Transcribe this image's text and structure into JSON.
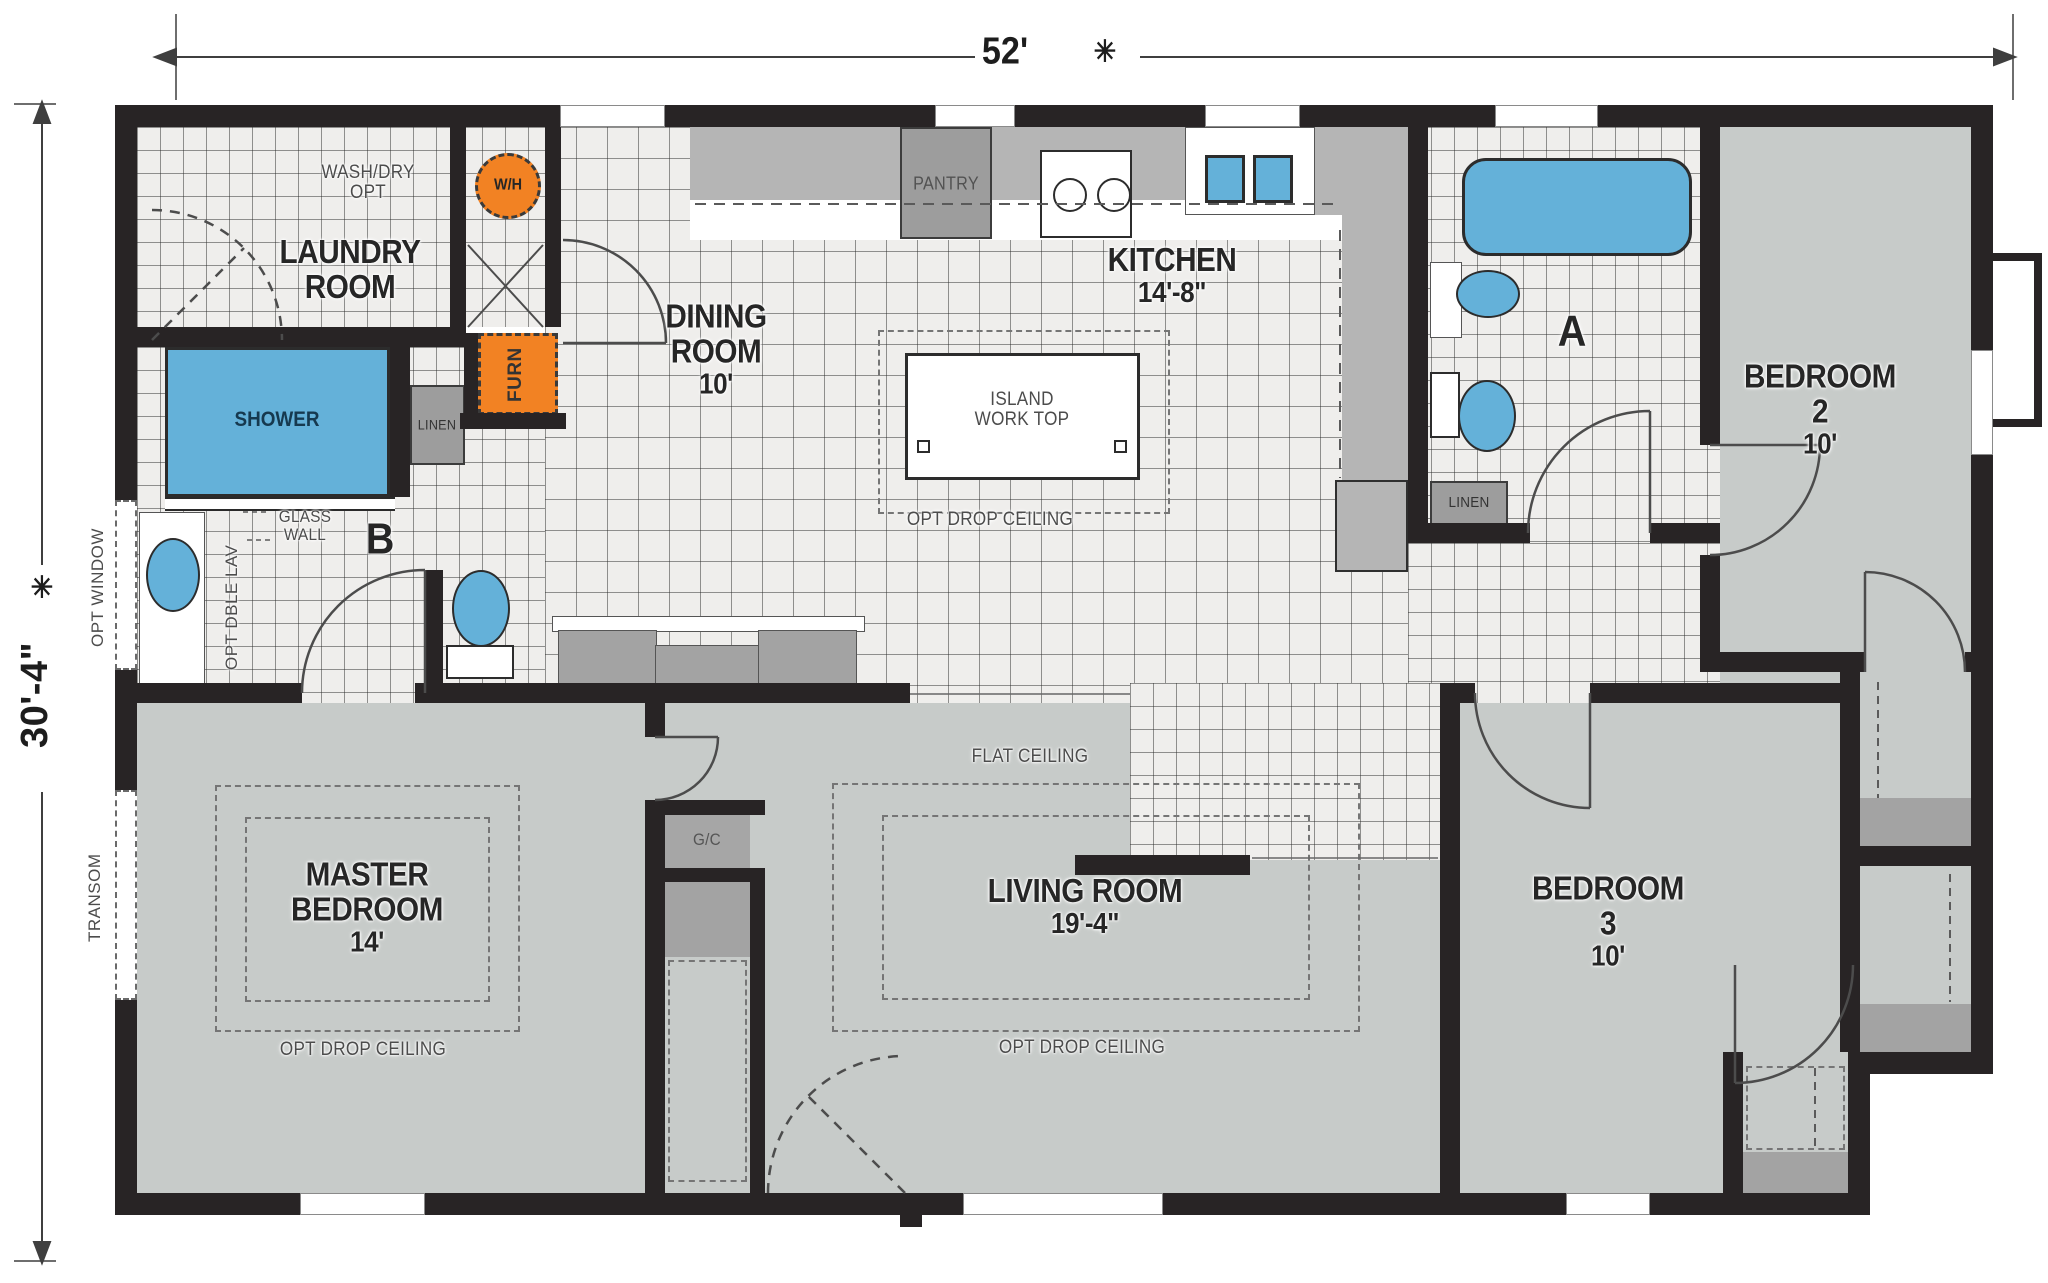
{
  "plan": {
    "dim_width": "52'",
    "dim_height": "30'-4\"",
    "star": "✳"
  },
  "rooms": {
    "laundry": {
      "lines": [
        "LAUNDRY",
        "ROOM"
      ]
    },
    "dining": {
      "lines": [
        "DINING",
        "ROOM",
        "10'"
      ]
    },
    "kitchen": {
      "lines": [
        "KITCHEN",
        "14'-8\""
      ]
    },
    "bedroom2": {
      "lines": [
        "BEDROOM",
        "2",
        "10'"
      ]
    },
    "bedroom3": {
      "lines": [
        "BEDROOM",
        "3",
        "10'"
      ]
    },
    "master": {
      "lines": [
        "MASTER",
        "BEDROOM",
        "14'"
      ]
    },
    "living": {
      "lines": [
        "LIVING ROOM",
        "19'-4\""
      ]
    }
  },
  "labels": {
    "wash_dry": {
      "lines": [
        "WASH/DRY",
        "OPT"
      ]
    },
    "wh": "W/H",
    "furn": "FURN",
    "pantry": "PANTRY",
    "linen_b": "LINEN",
    "linen_a": "LINEN",
    "island": {
      "lines": [
        "ISLAND",
        "WORK TOP"
      ]
    },
    "opt_drop_ceiling_kitchen": "OPT DROP CEILING",
    "opt_drop_ceiling_master": "OPT DROP CEILING",
    "opt_drop_ceiling_living": "OPT DROP CEILING",
    "flat_ceiling": "FLAT CEILING",
    "shower": "SHOWER",
    "glass_wall": {
      "lines": [
        "GLASS",
        "WALL"
      ]
    },
    "opt_dble_lav": "OPT DBLE LAV",
    "opt_window": "OPT WINDOW",
    "transom": "TRANSOM",
    "gc": "G/C",
    "bath_a": "A",
    "bath_b": "B"
  },
  "colors": {
    "wall": "#282425",
    "fixture": "#64b1d9",
    "appliance": "#f28223",
    "closet": "#9d9d9d",
    "counter": "#b5b5b5",
    "carpet": "#c7cbc9",
    "tile": "#efeeec"
  }
}
